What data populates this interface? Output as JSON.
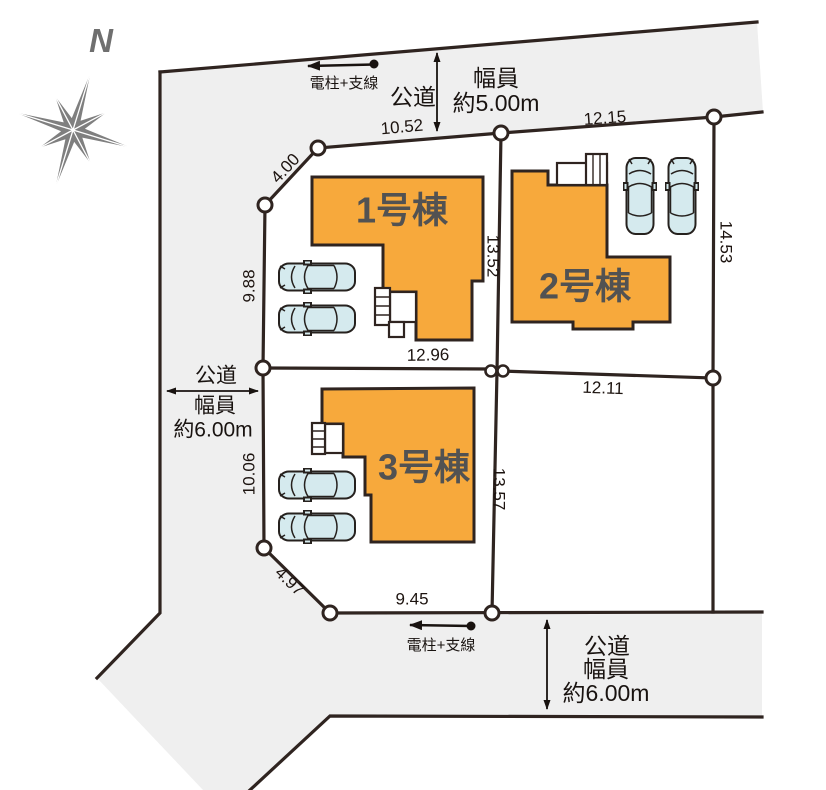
{
  "compass": {
    "north_label": "N"
  },
  "buildings": {
    "b1": {
      "label": "1号棟"
    },
    "b2": {
      "label": "2号棟"
    },
    "b3": {
      "label": "3号棟"
    }
  },
  "roads": {
    "top": {
      "name": "公道",
      "width_line1": "幅員",
      "width_line2": "約5.00m"
    },
    "left": {
      "name": "公道",
      "width_line1": "幅員",
      "width_line2": "約6.00m"
    },
    "bottom": {
      "name": "公道",
      "width_line1": "幅員",
      "width_line2": "約6.00m"
    }
  },
  "utility": {
    "top_label": "電柱+支線",
    "bottom_label": "電柱+支線"
  },
  "dimensions": {
    "top_left_edge": "10.52",
    "top_right_edge": "12.15",
    "corner_nw": "4.00",
    "left_upper": "9.88",
    "left_lower": "10.06",
    "center_upper": "13.52",
    "center_lower": "13.57",
    "right_edge": "14.53",
    "middle_left": "12.96",
    "middle_right": "12.11",
    "corner_sw": "4.97",
    "bottom_edge": "9.45"
  },
  "colors": {
    "building_fill": "#F7A93C",
    "road_fill": "#EFEFEF",
    "line": "#2F2420",
    "car_fill": "#D5EAEE",
    "label_gray": "#525252",
    "compass_gray": "#7F7F7F"
  }
}
